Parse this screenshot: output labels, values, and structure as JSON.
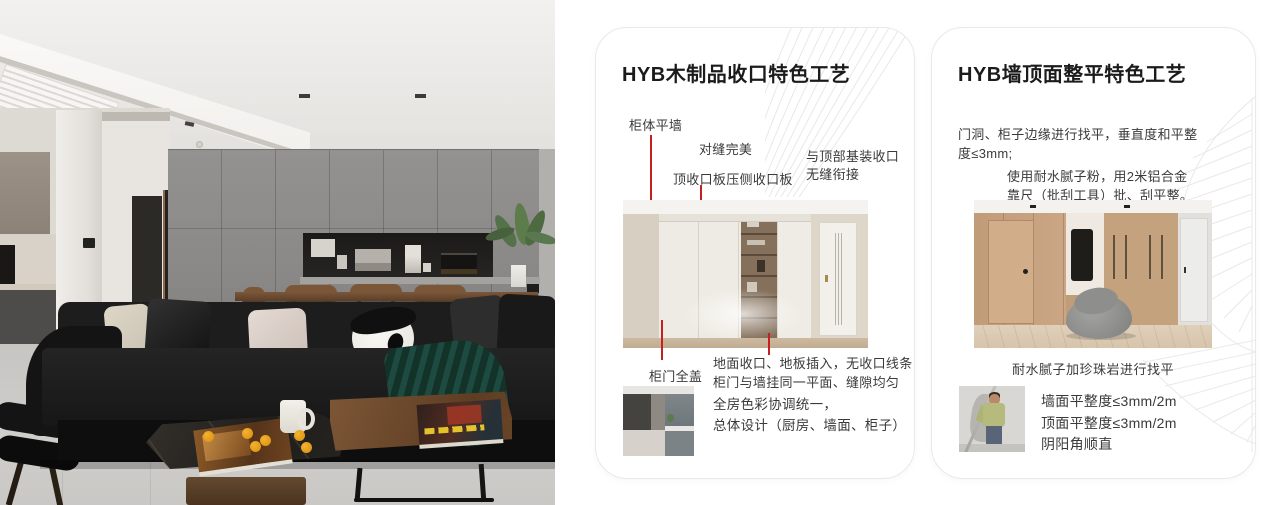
{
  "colors": {
    "accent_red": "#c51f1f",
    "card_border": "#e9e9e9",
    "pattern_gray": "#e8e8e8",
    "title_text": "#1b1b1b",
    "body_text": "#3a3a3a"
  },
  "card1": {
    "title": "HYB木制品收口特色工艺",
    "callout_cabinet_wall": "柜体平墙",
    "callout_seam": "对缝完美",
    "callout_top_board": "顶收口板压侧收口板",
    "callout_top_joint": [
      "与顶部基装收口",
      "无缝衔接"
    ],
    "callout_door_cover": "柜门全盖",
    "callout_floor": [
      "地面收口、地板插入，无收口线条",
      "柜门与墙挂同一平面、缝隙均匀"
    ],
    "summary": [
      "全房色彩协调统一，",
      "总体设计（厨房、墙面、柜子）"
    ]
  },
  "card2": {
    "title": "HYB墙顶面整平特色工艺",
    "para1": [
      "门洞、柜子边缘进行找平，垂直度和平整",
      "度≤3mm;"
    ],
    "para2": [
      "使用耐水腻子粉，用2米铝合金",
      "靠尺（批刮工具）批、刮平整。"
    ],
    "caption": "耐水腻子加珍珠岩进行找平",
    "specs": [
      "墙面平整度≤3mm/2m",
      "顶面平整度≤3mm/2m",
      "阴阳角顺直"
    ]
  }
}
